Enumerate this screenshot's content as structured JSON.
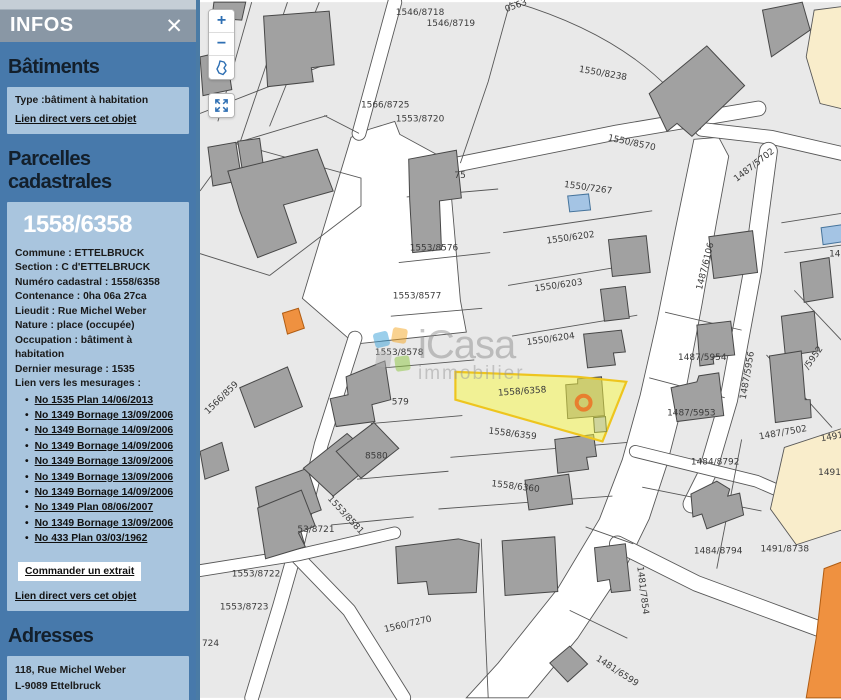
{
  "panel": {
    "header": {
      "title": "INFOS",
      "close_icon": "✕"
    },
    "batiments": {
      "heading": "Bâtiments",
      "type_line": "Type :bâtiment à habitation",
      "link": "Lien direct vers cet objet"
    },
    "parcelles": {
      "heading": "Parcelles cadastrales",
      "parcel_id": "1558/6358",
      "details": [
        "Commune : ETTELBRUCK",
        "Section : C d'ETTELBRUCK",
        "Numéro cadastral : 1558/6358",
        "Contenance : 0ha 06a 27ca",
        "Lieudit : Rue Michel Weber",
        "Nature : place (occupée)",
        "Occupation : bâtiment à habitation",
        "Dernier mesurage : 1535",
        "Lien vers les mesurages :"
      ],
      "mesurages": [
        "No 1535 Plan 14/06/2013",
        "No 1349 Bornage 13/09/2006",
        "No 1349 Bornage 14/09/2006",
        "No 1349 Bornage 14/09/2006",
        "No 1349 Bornage 13/09/2006",
        "No 1349 Bornage 13/09/2006",
        "No 1349 Bornage 14/09/2006",
        "No 1349 Plan 08/06/2007",
        "No 1349 Bornage 13/09/2006",
        "No 433 Plan 03/03/1962"
      ],
      "order_button": "Commander un extrait",
      "link": "Lien direct vers cet objet"
    },
    "adresses": {
      "heading": "Adresses",
      "lines": [
        "118, Rue Michel Weber",
        "L-9089 Ettelbruck"
      ],
      "link": "Lien direct vers cet objet"
    }
  },
  "map": {
    "selected_parcel": "1558/6358",
    "controls": {
      "zoom_in": "+",
      "zoom_out": "−"
    },
    "watermark": {
      "name": "iCasa",
      "sub": "immobilier"
    },
    "colors": {
      "parcel": "#e9e9e9",
      "line": "#575757",
      "road": "#ffffff",
      "building": "#a1a1a1",
      "building_stroke": "#474747",
      "blue_building": "#a4c4e4",
      "blue_stroke": "#46749c",
      "orange_building": "#ef9140",
      "orange_stroke": "#b05c12",
      "beige": "#f9edcb",
      "yellow": "#f9f942",
      "yellow_stroke": "#eec51e",
      "marker": "#e87f2f",
      "label": "#3b3b3b",
      "selected_label": "#8c8c3a",
      "accent": "#2e6fb3"
    },
    "white_areas": [
      "103,298 152,136 170,128 196,120 201,133 256,163 252,184 262,300 268,332 156,344",
      "497,138 522,136 532,155 520,220 505,305 488,395 470,465 452,520 430,565 380,640 330,700 268,700 300,665 360,590 402,520 425,460 443,395 460,320 478,230"
    ],
    "roads": [
      {
        "d": "M196,0 L160,132",
        "w": 13
      },
      {
        "d": "M250,165 L420,131 L562,107",
        "w": 14
      },
      {
        "d": "M505,128 L575,136 L649,153",
        "w": 13
      },
      {
        "d": "M572,150 L556,270 L532,400 L510,475 L495,505",
        "w": 17
      },
      {
        "d": "M156,338 L122,445 L98,545 L80,608 L52,700",
        "w": 13
      },
      {
        "d": "M95,555 L150,612 L205,700",
        "w": 13
      },
      {
        "d": "M0,572 L100,556 L196,534",
        "w": 11
      },
      {
        "d": "M420,545 L500,585 L600,622 L649,640",
        "w": 15
      },
      {
        "d": "M438,452 L560,482 L590,495",
        "w": 11
      }
    ],
    "boundaries": [
      "M52,0 L18,120",
      "M88,0 L40,142",
      "M120,0 L70,125",
      "M0,112 L128,62",
      "M125,114 L160,132",
      "M0,190 L35,142 L128,114",
      "M35,142 L162,177 L162,205",
      "M162,205 L70,275",
      "M70,275 L0,253",
      "M312,0 L290,80 L262,162",
      "M316,0 Q450,40 504,128",
      "M208,196 L300,188",
      "M200,262 L292,252",
      "M192,316 L284,308",
      "M184,368 L276,360",
      "M172,424 L264,416",
      "M158,480 L250,472",
      "M132,526 L215,518",
      "M305,232 L455,210",
      "M310,285 L448,262",
      "M314,336 L440,315",
      "M252,458 L430,443",
      "M240,510 L415,497",
      "M283,540 L290,700",
      "M388,528 L436,545",
      "M372,612 L430,640",
      "M468,312 L545,330",
      "M452,378 L528,398",
      "M585,222 L649,212",
      "M588,252 L649,244",
      "M598,290 L649,344",
      "M570,355 L636,428",
      "M545,440 L520,570",
      "M445,488 L565,512"
    ],
    "beige_areas": [
      "618,8 649,4 649,108 624,102 610,55",
      "588,448 649,428 649,530 600,546 574,510"
    ],
    "buildings": [
      {
        "pts": "14,0 46,0 42,18 12,16"
      },
      {
        "pts": "64,14 130,9 135,63 112,66 114,80 68,85"
      },
      {
        "pts": "0,55 26,49 32,88 3,94"
      },
      {
        "pts": "8,146 36,141 42,179 13,185"
      },
      {
        "pts": "38,140 60,137 65,174 44,178"
      },
      {
        "pts": "28,170 118,148 134,190 84,204 97,242 58,257 40,210"
      },
      {
        "pts": "40,388 88,367 103,407 55,428"
      },
      {
        "pts": "56,488 108,469 122,511 98,520 105,545 68,558"
      },
      {
        "pts": "0,452 22,443 29,471 5,480"
      },
      {
        "pts": "210,158 258,149 263,197 241,200 243,249 214,252 211,199"
      },
      {
        "pts": "131,399 149,395 147,377 186,361 192,400 173,405 176,422 137,427"
      },
      {
        "pts": "104,469 148,434 178,461 134,497"
      },
      {
        "pts": "137,452 175,423 200,449 162,479"
      },
      {
        "pts": "58,509 102,491 116,527 99,534 106,548 66,560"
      },
      {
        "pts": "370,195 391,193 393,209 372,211",
        "kind": "blue"
      },
      {
        "pts": "411,239 449,235 453,272 415,276"
      },
      {
        "pts": "403,289 428,286 432,318 407,321"
      },
      {
        "pts": "386,334 424,330 428,352 416,353 418,365 390,368"
      },
      {
        "pts": "368,385 380,384 380,379 404,377 407,416 370,419"
      },
      {
        "pts": "357,440 396,435 399,457 389,458 391,470 360,474"
      },
      {
        "pts": "327,481 371,475 375,505 331,511"
      },
      {
        "pts": "197,548 260,540 281,545 278,594 230,596 228,583 199,585"
      },
      {
        "pts": "304,542 357,538 360,593 307,597"
      },
      {
        "pts": "452,92 510,44 548,84 495,135 480,122 470,130"
      },
      {
        "pts": "566,8 606,0 614,28 575,55"
      },
      {
        "pts": "512,236 556,230 561,272 517,278"
      },
      {
        "pts": "500,325 534,321 538,355 516,357 517,364 503,366"
      },
      {
        "pts": "474,388 500,382 502,376 522,373 527,416 480,422"
      },
      {
        "pts": "604,262 633,257 637,297 608,302"
      },
      {
        "pts": "625,227 646,224 647,241 627,244",
        "kind": "blue"
      },
      {
        "pts": "585,316 618,311 622,351 589,356"
      },
      {
        "pts": "573,356 605,351 609,400 614,400 615,418 579,423"
      },
      {
        "pts": "397,549 428,545 433,592 414,594 412,581 400,583"
      },
      {
        "pts": "352,665 372,648 390,666 370,684"
      },
      {
        "pts": "494,495 520,482 533,490 531,497 543,494 547,516 510,530 505,515 496,518"
      },
      {
        "pts": "83,313 99,308 105,328 88,334",
        "kind": "orange"
      },
      {
        "pts": "628,570 649,562 649,700 610,700 620,640",
        "kind": "orange"
      }
    ],
    "selected_area": {
      "pts": "257,372 380,377 429,382 405,442 257,400",
      "pale_building": "396,418 408,417 409,432 397,433",
      "marker": {
        "cx": 386,
        "cy": 403,
        "r": 7
      }
    },
    "labels": [
      {
        "t": "1546/8718",
        "x": 197,
        "y": 13
      },
      {
        "t": "1546/8719",
        "x": 228,
        "y": 24
      },
      {
        "t": "0563",
        "x": 308,
        "y": 10,
        "r": -20
      },
      {
        "t": "1550/8238",
        "x": 381,
        "y": 70,
        "r": 10
      },
      {
        "t": "1566/8725",
        "x": 162,
        "y": 106
      },
      {
        "t": "1553/8720",
        "x": 197,
        "y": 120
      },
      {
        "t": "1550/8570",
        "x": 410,
        "y": 139,
        "r": 12
      },
      {
        "t": "1550/7267",
        "x": 366,
        "y": 186,
        "r": 8
      },
      {
        "t": "1487/5702",
        "x": 540,
        "y": 181,
        "r": -38
      },
      {
        "t": "75",
        "x": 256,
        "y": 177
      },
      {
        "t": "1553/8576",
        "x": 211,
        "y": 250
      },
      {
        "t": "1550/6202",
        "x": 349,
        "y": 243,
        "r": -8
      },
      {
        "t": "1553/8577",
        "x": 194,
        "y": 298
      },
      {
        "t": "1550/6203",
        "x": 337,
        "y": 291,
        "r": -8
      },
      {
        "t": "1487/6106",
        "x": 505,
        "y": 290,
        "r": -76
      },
      {
        "t": "1553/8578",
        "x": 176,
        "y": 355
      },
      {
        "t": "1550/6204",
        "x": 329,
        "y": 345,
        "r": -8
      },
      {
        "t": "1558/6358",
        "x": 300,
        "y": 396,
        "r": -4,
        "sel": true
      },
      {
        "t": "1566/859",
        "x": 8,
        "y": 415,
        "r": -44
      },
      {
        "t": "579",
        "x": 193,
        "y": 405
      },
      {
        "t": "8580",
        "x": 166,
        "y": 459
      },
      {
        "t": "1553/8581",
        "x": 128,
        "y": 500,
        "r": 47
      },
      {
        "t": "53/8721",
        "x": 98,
        "y": 533
      },
      {
        "t": "1553/8722",
        "x": 32,
        "y": 578
      },
      {
        "t": "1553/8723",
        "x": 20,
        "y": 611
      },
      {
        "t": "724",
        "x": 2,
        "y": 648
      },
      {
        "t": "1560/7270",
        "x": 186,
        "y": 634,
        "r": -13
      },
      {
        "t": "1558/6359",
        "x": 290,
        "y": 434,
        "r": 7
      },
      {
        "t": "1558/6360",
        "x": 293,
        "y": 487,
        "r": 7
      },
      {
        "t": "1487/5954",
        "x": 481,
        "y": 360
      },
      {
        "t": "1487/5953",
        "x": 470,
        "y": 416
      },
      {
        "t": "1487/5956",
        "x": 549,
        "y": 400,
        "r": -80
      },
      {
        "t": "/5952",
        "x": 612,
        "y": 370,
        "r": -55
      },
      {
        "t": "148",
        "x": 633,
        "y": 256
      },
      {
        "t": "1487/7502",
        "x": 563,
        "y": 440,
        "r": -10
      },
      {
        "t": "1491/",
        "x": 625,
        "y": 442,
        "r": -10
      },
      {
        "t": "1491/8",
        "x": 622,
        "y": 476
      },
      {
        "t": "1484/8792",
        "x": 494,
        "y": 465
      },
      {
        "t": "1484/8794",
        "x": 497,
        "y": 555
      },
      {
        "t": "1491/8738",
        "x": 564,
        "y": 553
      },
      {
        "t": "1481/7854",
        "x": 440,
        "y": 568,
        "r": 83
      },
      {
        "t": "1481/6599",
        "x": 398,
        "y": 662,
        "r": 33
      }
    ]
  }
}
